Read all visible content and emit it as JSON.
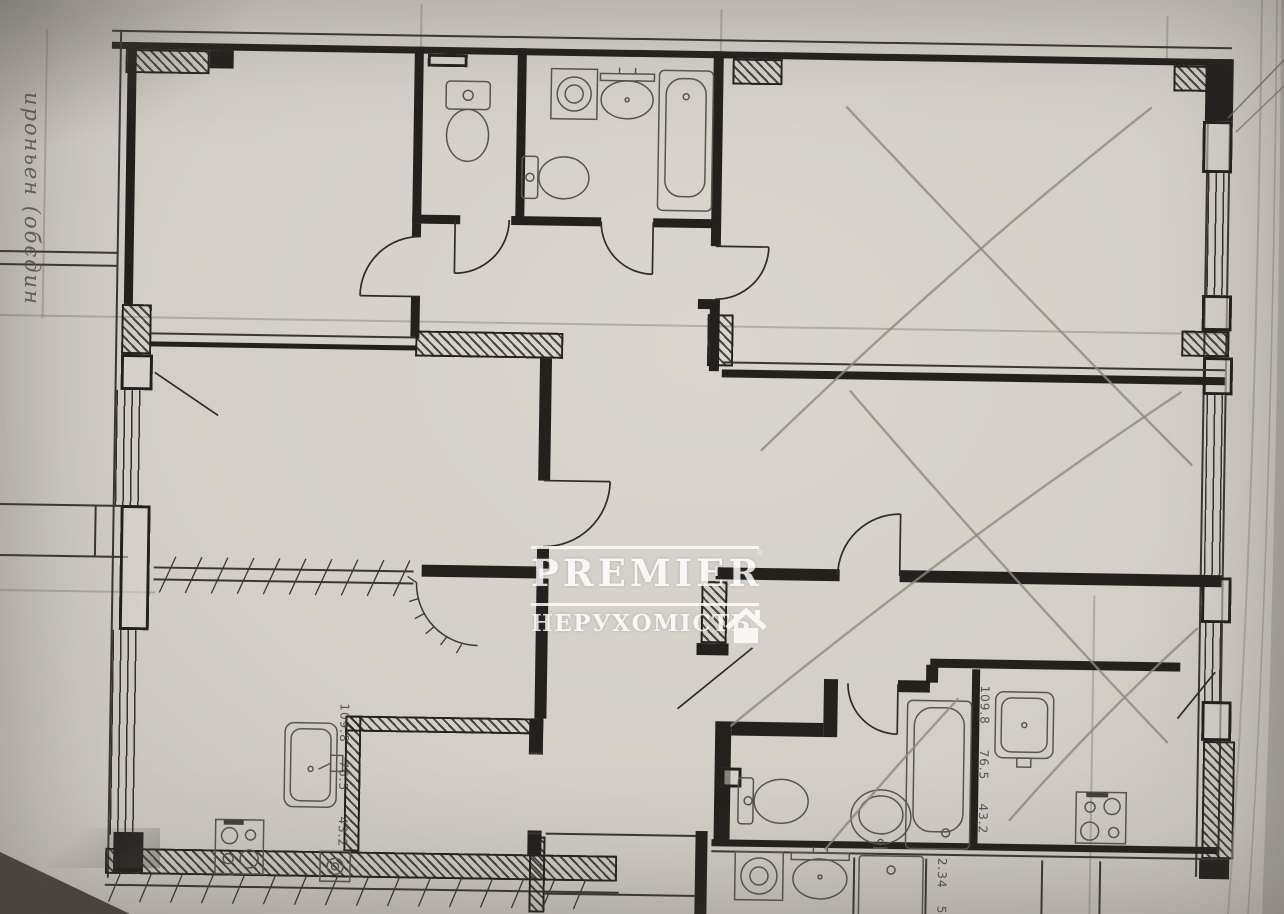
{
  "photo": {
    "paper_color": "#d3cfc8",
    "ink_color": "#23211e",
    "pencil_color": "#8f887e",
    "table_color": "#4a4540"
  },
  "handwriting": {
    "note": "ироньен (обєдин",
    "color": "#55504a"
  },
  "watermark": {
    "brand": "PREMIER",
    "registered_mark": "®",
    "subtitle": "НЕРУХОМІСТЬ",
    "house_icon": "house-icon",
    "color": "#ffffff"
  },
  "plan": {
    "dimension_labels": {
      "column": [
        "109.8",
        "76.5",
        "43.2"
      ],
      "bottom": [
        "2.34",
        "5"
      ]
    },
    "fixture_icons": [
      "wc-toilet-icon",
      "washing-machine-icon",
      "bath-sink-icon",
      "bath-toilet-icon",
      "bathtub-icon",
      "bathroom2-toilet-icon",
      "round-sink-icon",
      "bathtub-2-icon",
      "kitchen-sink-icon",
      "stove-icon",
      "kitchen-sink-2-icon",
      "stove-2-icon",
      "washing-machine-2-icon",
      "oval-sink-icon",
      "shower-tray-icon",
      "gas-riser-icon"
    ],
    "annotations": {
      "pencil_marks": "pencil-x-marks",
      "demolition_ticks": "tick-marked-walls"
    }
  }
}
